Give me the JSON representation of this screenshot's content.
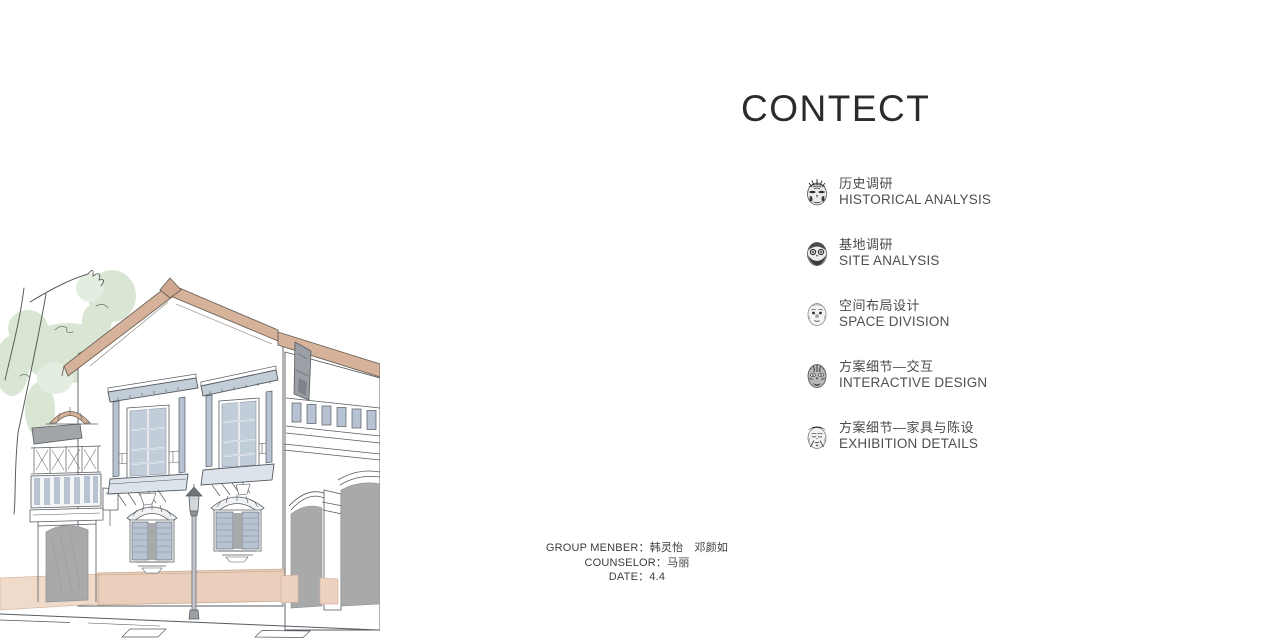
{
  "page": {
    "title": "CONTECT",
    "background": "#ffffff"
  },
  "contents": {
    "items": [
      {
        "icon": "opera-mask-jing-icon",
        "zh": "历史调研",
        "en": "HISTORICAL ANALYSIS"
      },
      {
        "icon": "opera-mask-bearded-icon",
        "zh": "基地调研",
        "en": "SITE ANALYSIS"
      },
      {
        "icon": "opera-mask-clown-icon",
        "zh": "空间布局设计",
        "en": "SPACE DIVISION"
      },
      {
        "icon": "opera-mask-dark-icon",
        "zh": "方案细节—交互",
        "en": "INTERACTIVE DESIGN"
      },
      {
        "icon": "opera-mask-elder-icon",
        "zh": "方案细节—家具与陈设",
        "en": "EXHIBITION DETAILS"
      }
    ]
  },
  "credits": {
    "lines": [
      {
        "label": "GROUP MENBER：",
        "value": "韩灵怡　邓颜如"
      },
      {
        "label": "COUNSELOR：",
        "value": "马丽"
      },
      {
        "label": "DATE：",
        "value": "4.4"
      }
    ]
  },
  "illustration": {
    "description": "hand-drawn watercolor sketch of a colonial street facade with bay windows, arched doors, lamppost and tree",
    "colors": {
      "roof_tan": "#d6b29b",
      "base_tan": "#e9cfbc",
      "window_blue": "#b7c3d2",
      "glass_blue": "#c2cdda",
      "door_gray": "#a7a9ab",
      "foliage_green": "#d9e6d4",
      "line": "#565b60"
    }
  }
}
